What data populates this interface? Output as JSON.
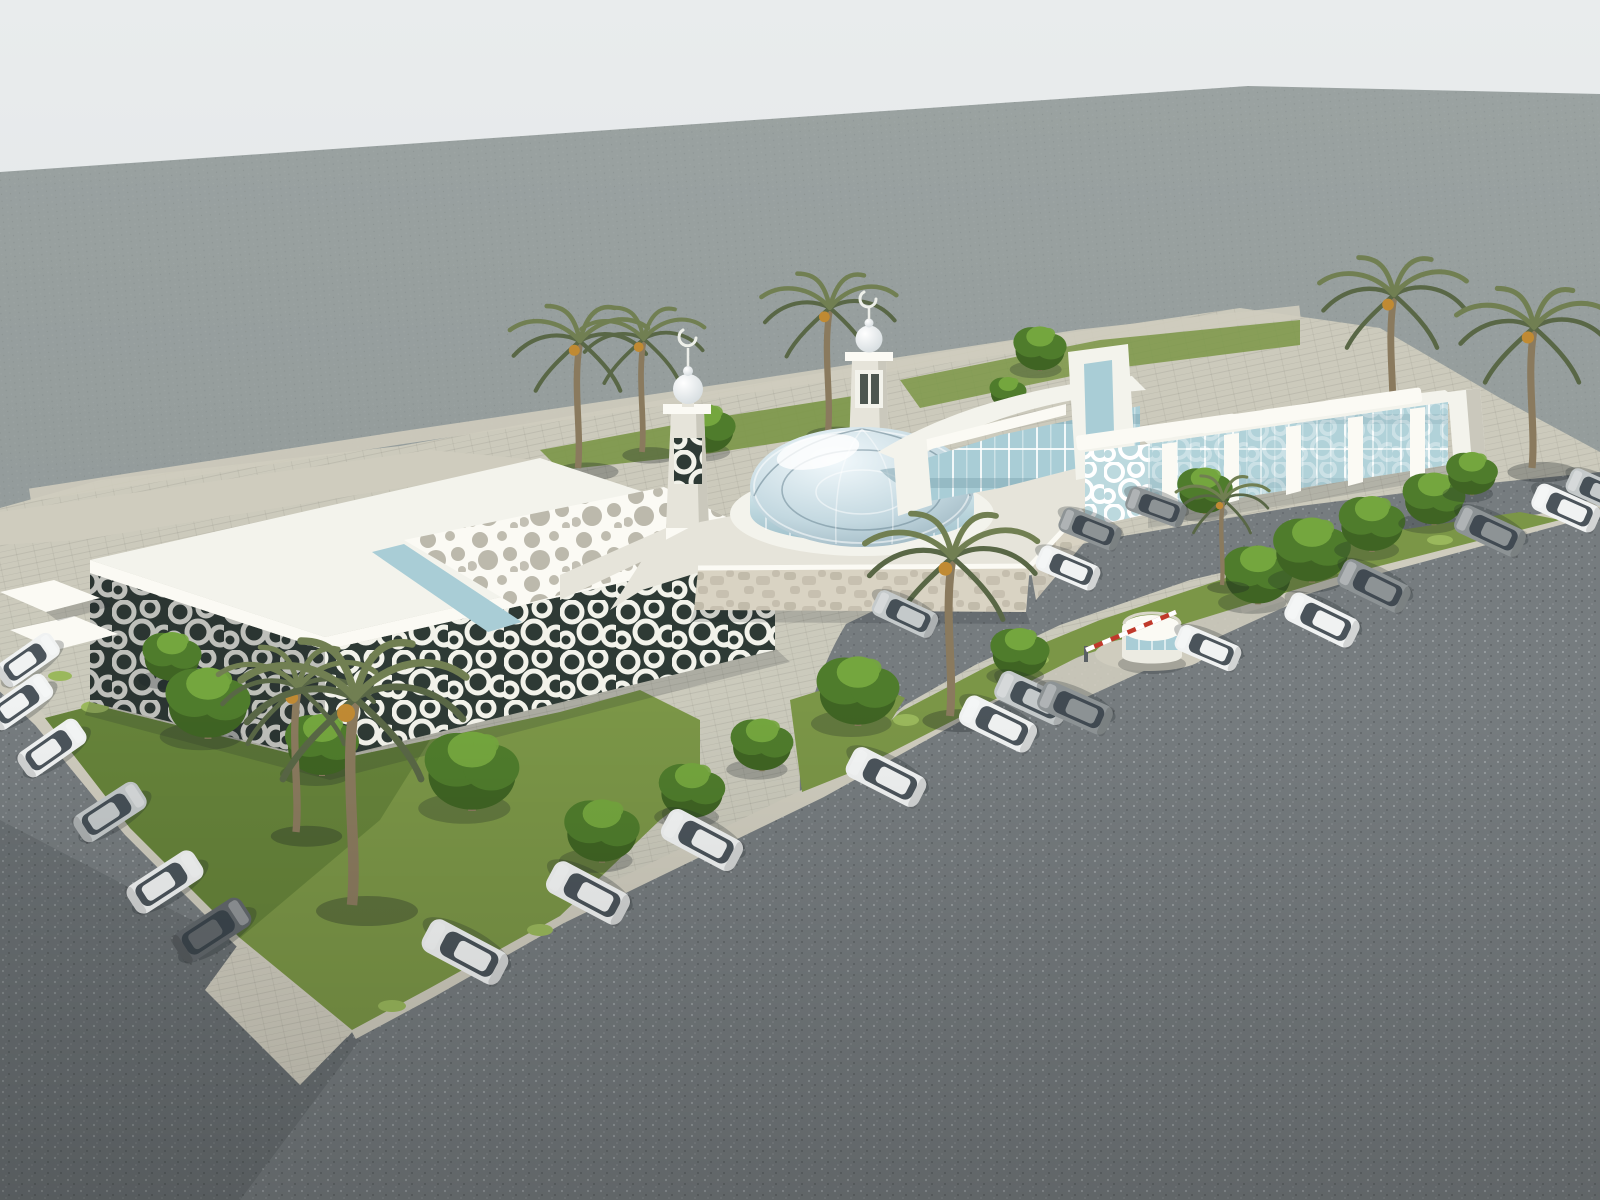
{
  "meta": {
    "title": "Aerial 3D architectural rendering of a white mosque complex",
    "description": "Bird's-eye rendering of a modern white mosque campus: a flat-roof wing with perforated roof canopy and arabesque lattice facade, a central glass lattice dome flanked by two crescent-topped minarets, a rear hall with curved roof, a colonnade wing with white fins and canopies, palm-lined gardens, a domed guard kiosk with striped barrier gate, paved sidewalks and asphalt parking lots dotted with white, silver and gray cars on a plain gray studio backdrop."
  },
  "scene": {
    "setting": "aerial three-quarter view, neutral gray backdrop, soft daylight",
    "buildings": {
      "left_wing": {
        "label": "flat-roof wing",
        "features": [
          "perforated circular-hole roof canopy",
          "linear skylight",
          "arabesque lattice glass facade",
          "twin entry canopies"
        ]
      },
      "mosque": {
        "label": "central prayer hall",
        "dome": "steel-and-glass lattice dome on round glass drum",
        "minarets": 2,
        "podium": "stone mosaic walls with white coping"
      },
      "rear_hall": {
        "label": "rear hall",
        "features": [
          "curved white roof band",
          "glass curtain wall",
          "tall window tower"
        ]
      },
      "right_wing": {
        "label": "colonnade wing",
        "features": [
          "five white fins with projecting canopies",
          "fritted glass band",
          "lattice end panel"
        ]
      }
    },
    "site_features": [
      "guard kiosk with dome roof",
      "red-white barrier gate",
      "paved sidewalks and corner plaza",
      "asphalt parking lots",
      "rear service walkway"
    ],
    "vegetation": {
      "palms": 9,
      "trees": 18,
      "lawns": 4,
      "shrub_tufts": 9
    },
    "vehicles": {
      "cars": 23,
      "colors": [
        "white",
        "silver",
        "gray",
        "dark gray"
      ]
    }
  },
  "colors": {
    "backdropTop": "#e9eced",
    "backdropBottom": "#d8dddf",
    "farGround": "#8f9796",
    "asphalt": "#767c7f",
    "asphaltLight": "#888e91",
    "speckleLight": "#bac0c2",
    "speckleDark": "#4e5456",
    "shadow": "#23292c",
    "pavement": "#cfccbe",
    "pavementShade": "#b5b2a4",
    "grass": "#7b9647",
    "grassDark": "#55742f",
    "grassLight": "#9ab85c",
    "treeDark": "#3f6423",
    "treeMid": "#4f7c2c",
    "treeLight": "#74a63e",
    "palmFrond": "#717f52",
    "palmFrondDark": "#596746",
    "palmTrunk": "#8a7a5e",
    "white": "#f3f3ec",
    "wall": "#e6e4da",
    "wallShade": "#cac8bc",
    "fascia": "#fbfaf4",
    "glass": "#a9cdd6",
    "glassDark": "#6e96a3",
    "latticeBg": "#2e3a35",
    "latticeWeb": "#f2f2ea",
    "stone": "#d9d3c3",
    "stoneSpot": "#b7b1a0",
    "domeHighlight": "#f2f9fc",
    "domeMid": "#c3d8e0",
    "domeShade": "#8ca6b2",
    "domeLine": "#64808d",
    "kiosk": "#ecebe2",
    "barrierRed": "#c0392b",
    "carWhite": "#f0f2f2",
    "carSilver": "#c4c9ca",
    "carGray": "#8d9395",
    "carDark": "#62686c",
    "carGlass": "#39424a",
    "dates": "#c08a33"
  }
}
